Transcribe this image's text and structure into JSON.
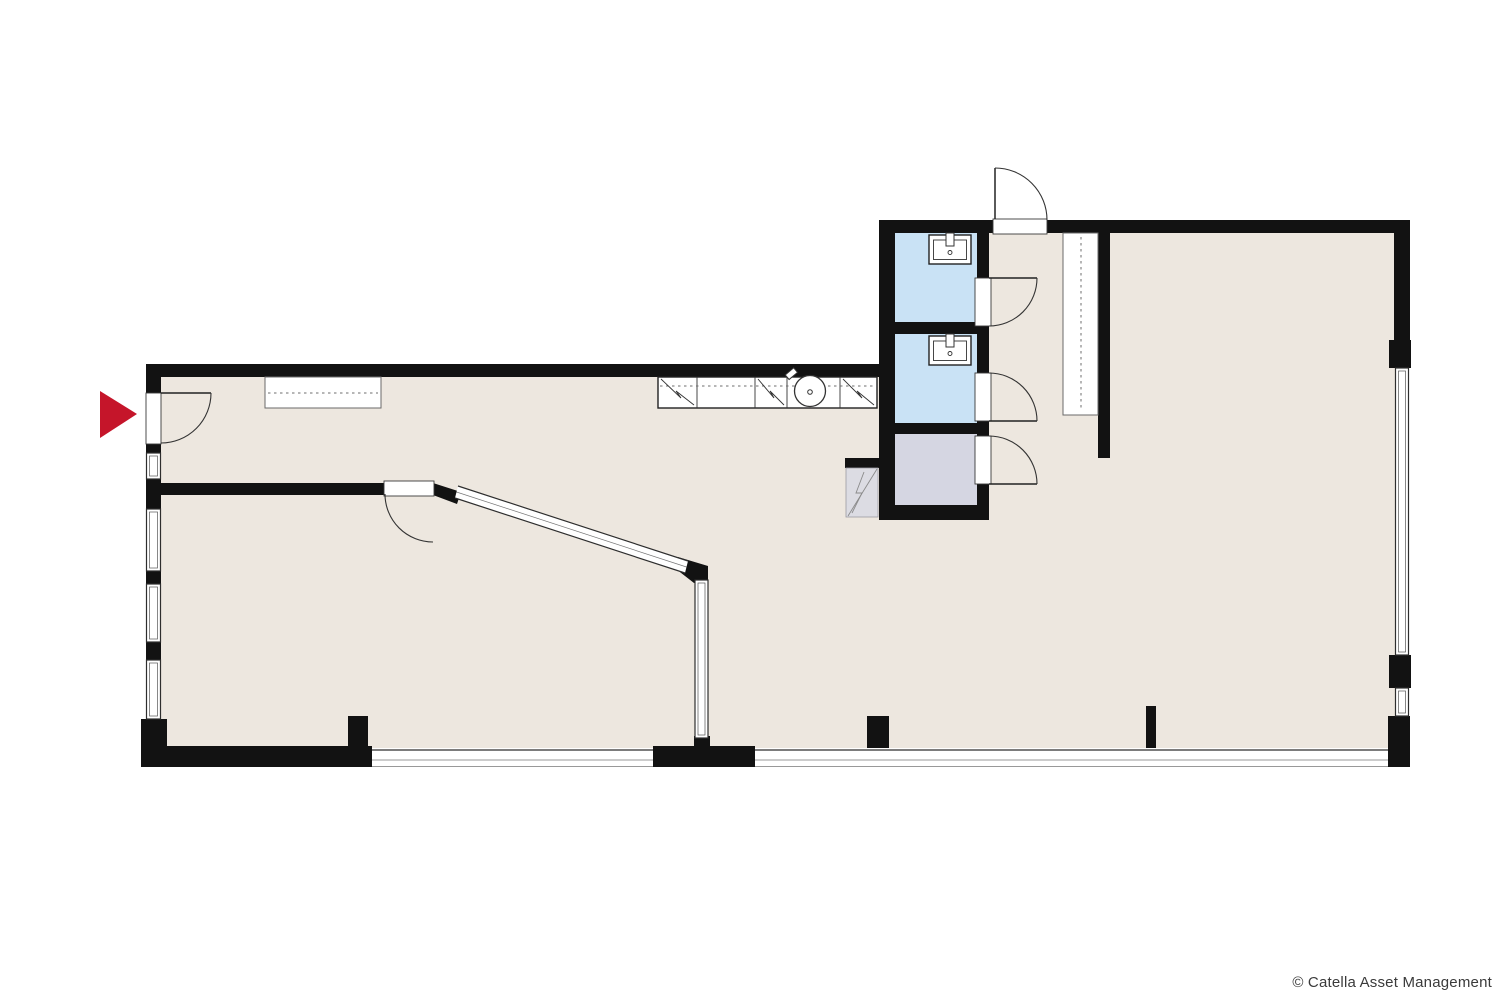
{
  "footer": {
    "copyright": "© Catella Asset Management"
  },
  "icons": {
    "entrance_marker": "red-triangle-arrow-right-icon"
  },
  "colors": {
    "background": "#ffffff",
    "floor": "#ede7df",
    "wall": "#121212",
    "wc_blue": "#c9e2f5",
    "storage_gray": "#d5d6e2",
    "cabinet_gray": "#dcdce3",
    "glass_line": "#2e2e2e",
    "fixture_line": "#222222",
    "dash_line": "#6e6e6e",
    "arrow_red": "#c5152a",
    "text": "#3a3a3a"
  }
}
